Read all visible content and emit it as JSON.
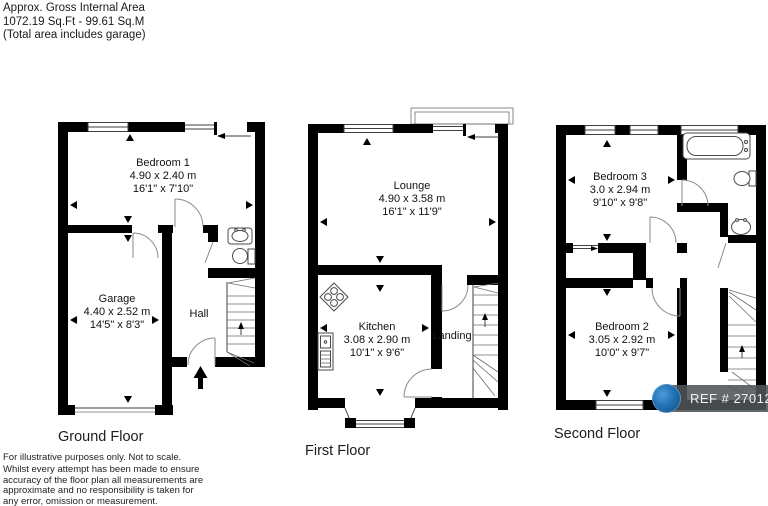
{
  "header": {
    "line1": "Approx. Gross Internal Area",
    "line2": "1072.19 Sq.Ft - 99.61 Sq.M",
    "line3": "(Total area includes garage)"
  },
  "disclaimer": {
    "line1": "For illustrative purposes only. Not to scale.",
    "line2": "Whilst every attempt has been made to ensure",
    "line3": "accuracy of the floor plan all measurements are",
    "line4": "approximate and no responsibility is taken for",
    "line5": "any error, omission or measurement."
  },
  "floors": {
    "ground": {
      "label": "Ground Floor",
      "rooms": {
        "bedroom1": {
          "name": "Bedroom 1",
          "metric": "4.90 x 2.40 m",
          "imperial": "16'1\" x 7'10\""
        },
        "garage": {
          "name": "Garage",
          "metric": "4.40 x 2.52 m",
          "imperial": "14'5\" x 8'3\""
        },
        "hall": {
          "name": "Hall"
        }
      }
    },
    "first": {
      "label": "First Floor",
      "rooms": {
        "lounge": {
          "name": "Lounge",
          "metric": "4.90 x 3.58 m",
          "imperial": "16'1\" x 11'9\""
        },
        "kitchen": {
          "name": "Kitchen",
          "metric": "3.08 x 2.90 m",
          "imperial": "10'1\" x 9'6\""
        },
        "landing": {
          "name": "Landing"
        }
      }
    },
    "second": {
      "label": "Second Floor",
      "rooms": {
        "bedroom3": {
          "name": "Bedroom 3",
          "metric": "3.0 x 2.94 m",
          "imperial": "9'10\" x 9'8\""
        },
        "bedroom2": {
          "name": "Bedroom 2",
          "metric": "3.05 x 2.92 m",
          "imperial": "10'0\" x 9'7\""
        }
      }
    }
  },
  "badge": {
    "ref": "REF # 2701266",
    "pill_color": "#4e5458",
    "logo_color": "#2273b8"
  },
  "colors": {
    "wall": "#000000",
    "thin_line": "#3f3f3f",
    "arc_line": "#8a8a8a"
  }
}
